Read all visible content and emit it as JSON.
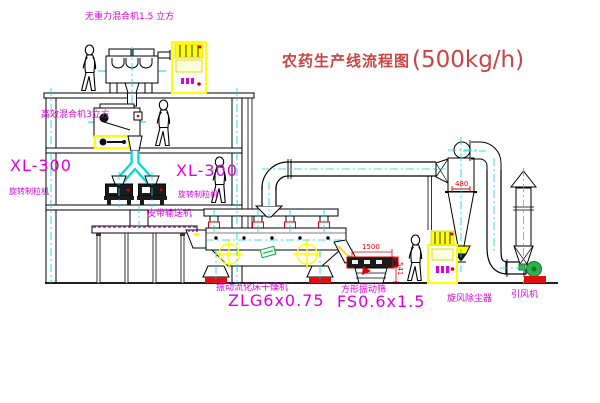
{
  "title": {
    "name": "农药生产线流程图",
    "capacity": "(500kg/h)"
  },
  "labels": {
    "gravity_mixer": "无重力混合机1.5 立方",
    "mid_mixer": "高效混合机3立方",
    "granulator_left_model": "XL-300",
    "granulator_left_name": "旋转制粒机",
    "granulator_right_model": "XL-300",
    "granulator_right_name": "旋转制粒机",
    "belt_conveyor": "皮带输送机",
    "dryer_name": "振动流化床干燥机",
    "dryer_model": "ZLG6x0.75",
    "sieve_name": "方形振动筛",
    "sieve_model": "FS0.6x1.5",
    "cyclone_name": "旋风除尘器",
    "fan_name": "引风机"
  },
  "dimensions": {
    "cyclone_width": "480",
    "sieve_length": "1500",
    "sieve_height": "541"
  },
  "colors": {
    "line": "#000000",
    "centerline": "#00d8d8",
    "label_magenta": "#dd00dd",
    "title_red": "#c94444",
    "dimension_red": "#e00000",
    "highlight_yellow": "#ffff00",
    "fan_green": "#2db34a"
  }
}
